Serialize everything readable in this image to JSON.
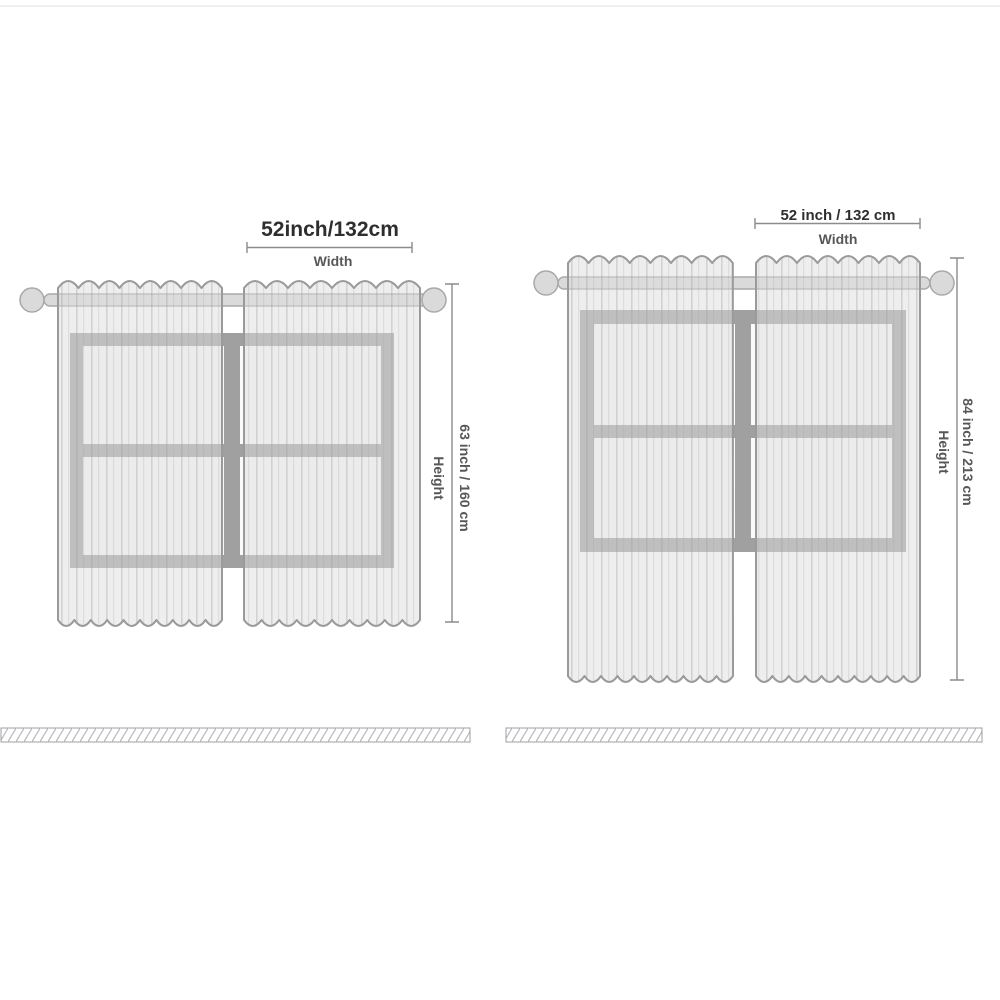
{
  "diagrams": [
    {
      "width_value": "52inch/132cm",
      "width_label": "Width",
      "height_value": "63 inch / 160 cm",
      "height_label": "Height"
    },
    {
      "width_value": "52 inch / 132 cm",
      "width_label": "Width",
      "height_value": "84 inch / 213 cm",
      "height_label": "Height"
    }
  ],
  "colors": {
    "background": "#ffffff",
    "text_primary": "#2e2e2e",
    "text_secondary": "#575757",
    "dimension_line": "#8c8c8c",
    "curtain_fill": "#dedede",
    "curtain_stripe": "#9e9e9e",
    "curtain_outline": "#9a9a9a",
    "window_frame": "#a0a0a0",
    "window_pane": "#fbfbfb",
    "rod_fill": "#dadada",
    "rod_outline": "#a9a9a9",
    "floor_hatch": "#bab6bf",
    "floor_border": "#9f9f9f"
  }
}
